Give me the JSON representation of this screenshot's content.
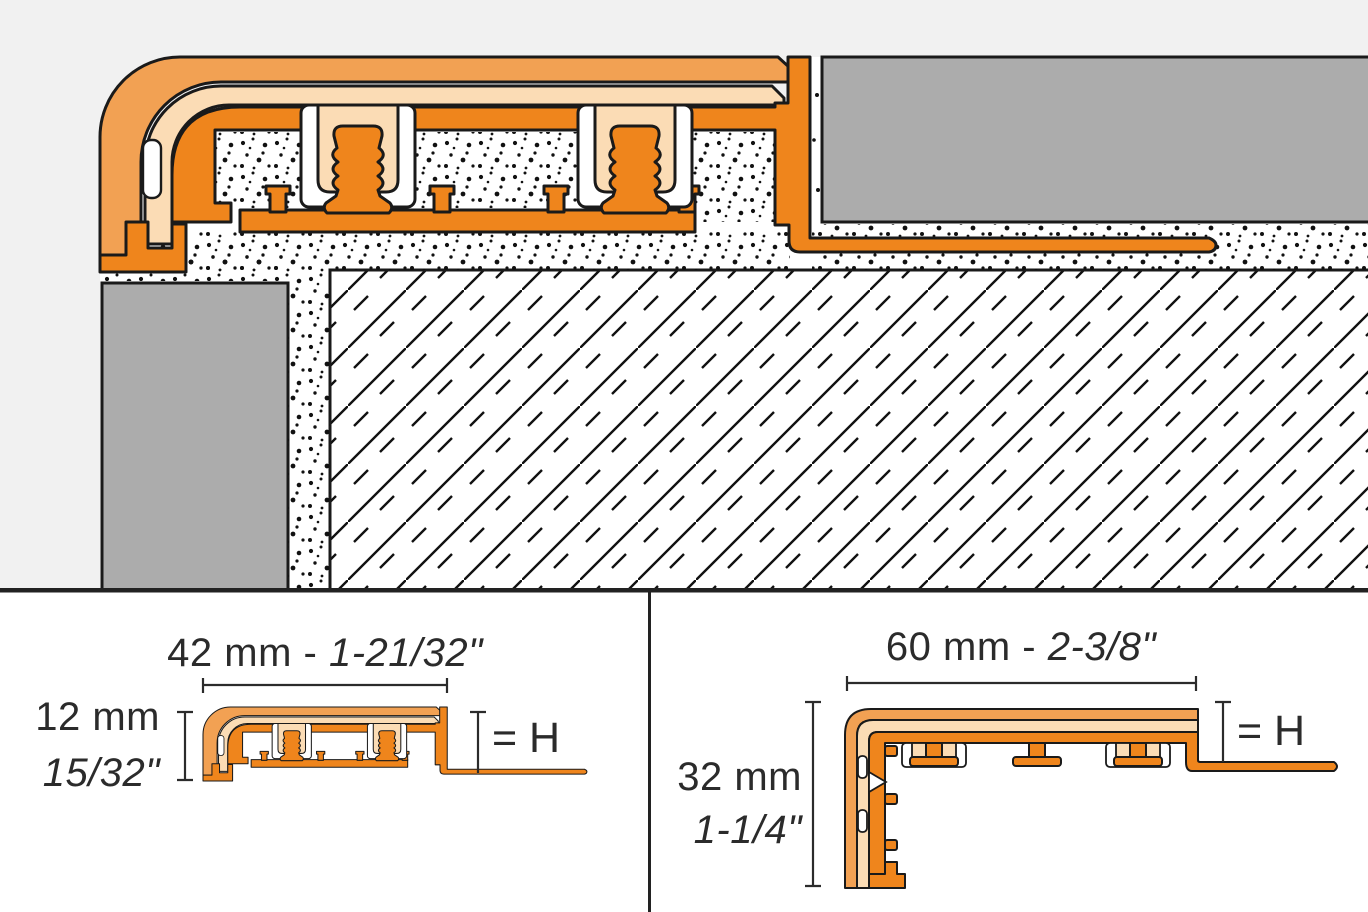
{
  "page": {
    "background_top": "#F1F1F1",
    "background_bottom": "#FFFFFF"
  },
  "main_view": {
    "description": "stair-nosing profile installed at step edge with tread tile, riser tile, thin-set mortar and concrete substrate"
  },
  "panel_left": {
    "width_label_metric": "42 mm - ",
    "width_label_imperial": "1-21/32\"",
    "height_label_metric": "12 mm",
    "height_label_imperial": "15/32\"",
    "height_reference": "= H"
  },
  "panel_right": {
    "width_label_metric": "60 mm - ",
    "width_label_imperial": "2-3/8\"",
    "height_label_metric": "32 mm",
    "height_label_imperial": "1-1/4\"",
    "height_reference": "= H"
  },
  "colors": {
    "profile_orange": "#EF851C",
    "wear_layer_orange": "#F2A153",
    "insert_peach": "#FBDCB5",
    "tile_gray": "#ACACAC",
    "outline_black": "#1A1A1A",
    "text_gray": "#2B2B2B"
  }
}
